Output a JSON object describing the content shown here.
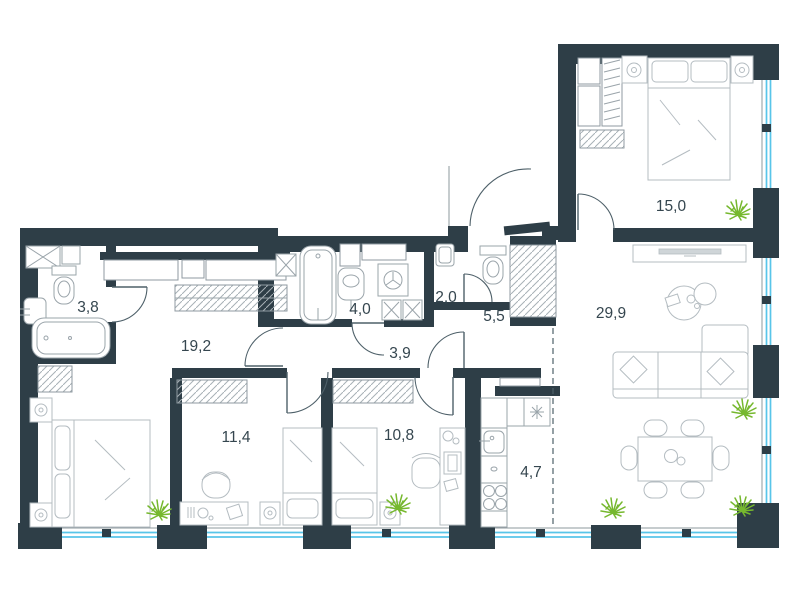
{
  "plan": {
    "rooms": [
      {
        "id": "bathroom-small",
        "area_label": "3,8"
      },
      {
        "id": "master-bedroom-hall",
        "area_label": "19,2"
      },
      {
        "id": "bathroom-main",
        "area_label": "4,0"
      },
      {
        "id": "wc",
        "area_label": "2,0"
      },
      {
        "id": "entry-hall",
        "area_label": "5,5"
      },
      {
        "id": "inner-corridor",
        "area_label": "3,9"
      },
      {
        "id": "living-room",
        "area_label": "29,9"
      },
      {
        "id": "bedroom-top",
        "area_label": "15,0"
      },
      {
        "id": "bedroom-left",
        "area_label": "11,4"
      },
      {
        "id": "bedroom-middle",
        "area_label": "10,8"
      },
      {
        "id": "kitchen",
        "area_label": "4,7"
      }
    ],
    "colors": {
      "wall": "#2e3e47",
      "window": "#58c5e9",
      "furniture": "#b4bcc1",
      "plant": "#76b82e",
      "label_text": "#35464f"
    }
  }
}
